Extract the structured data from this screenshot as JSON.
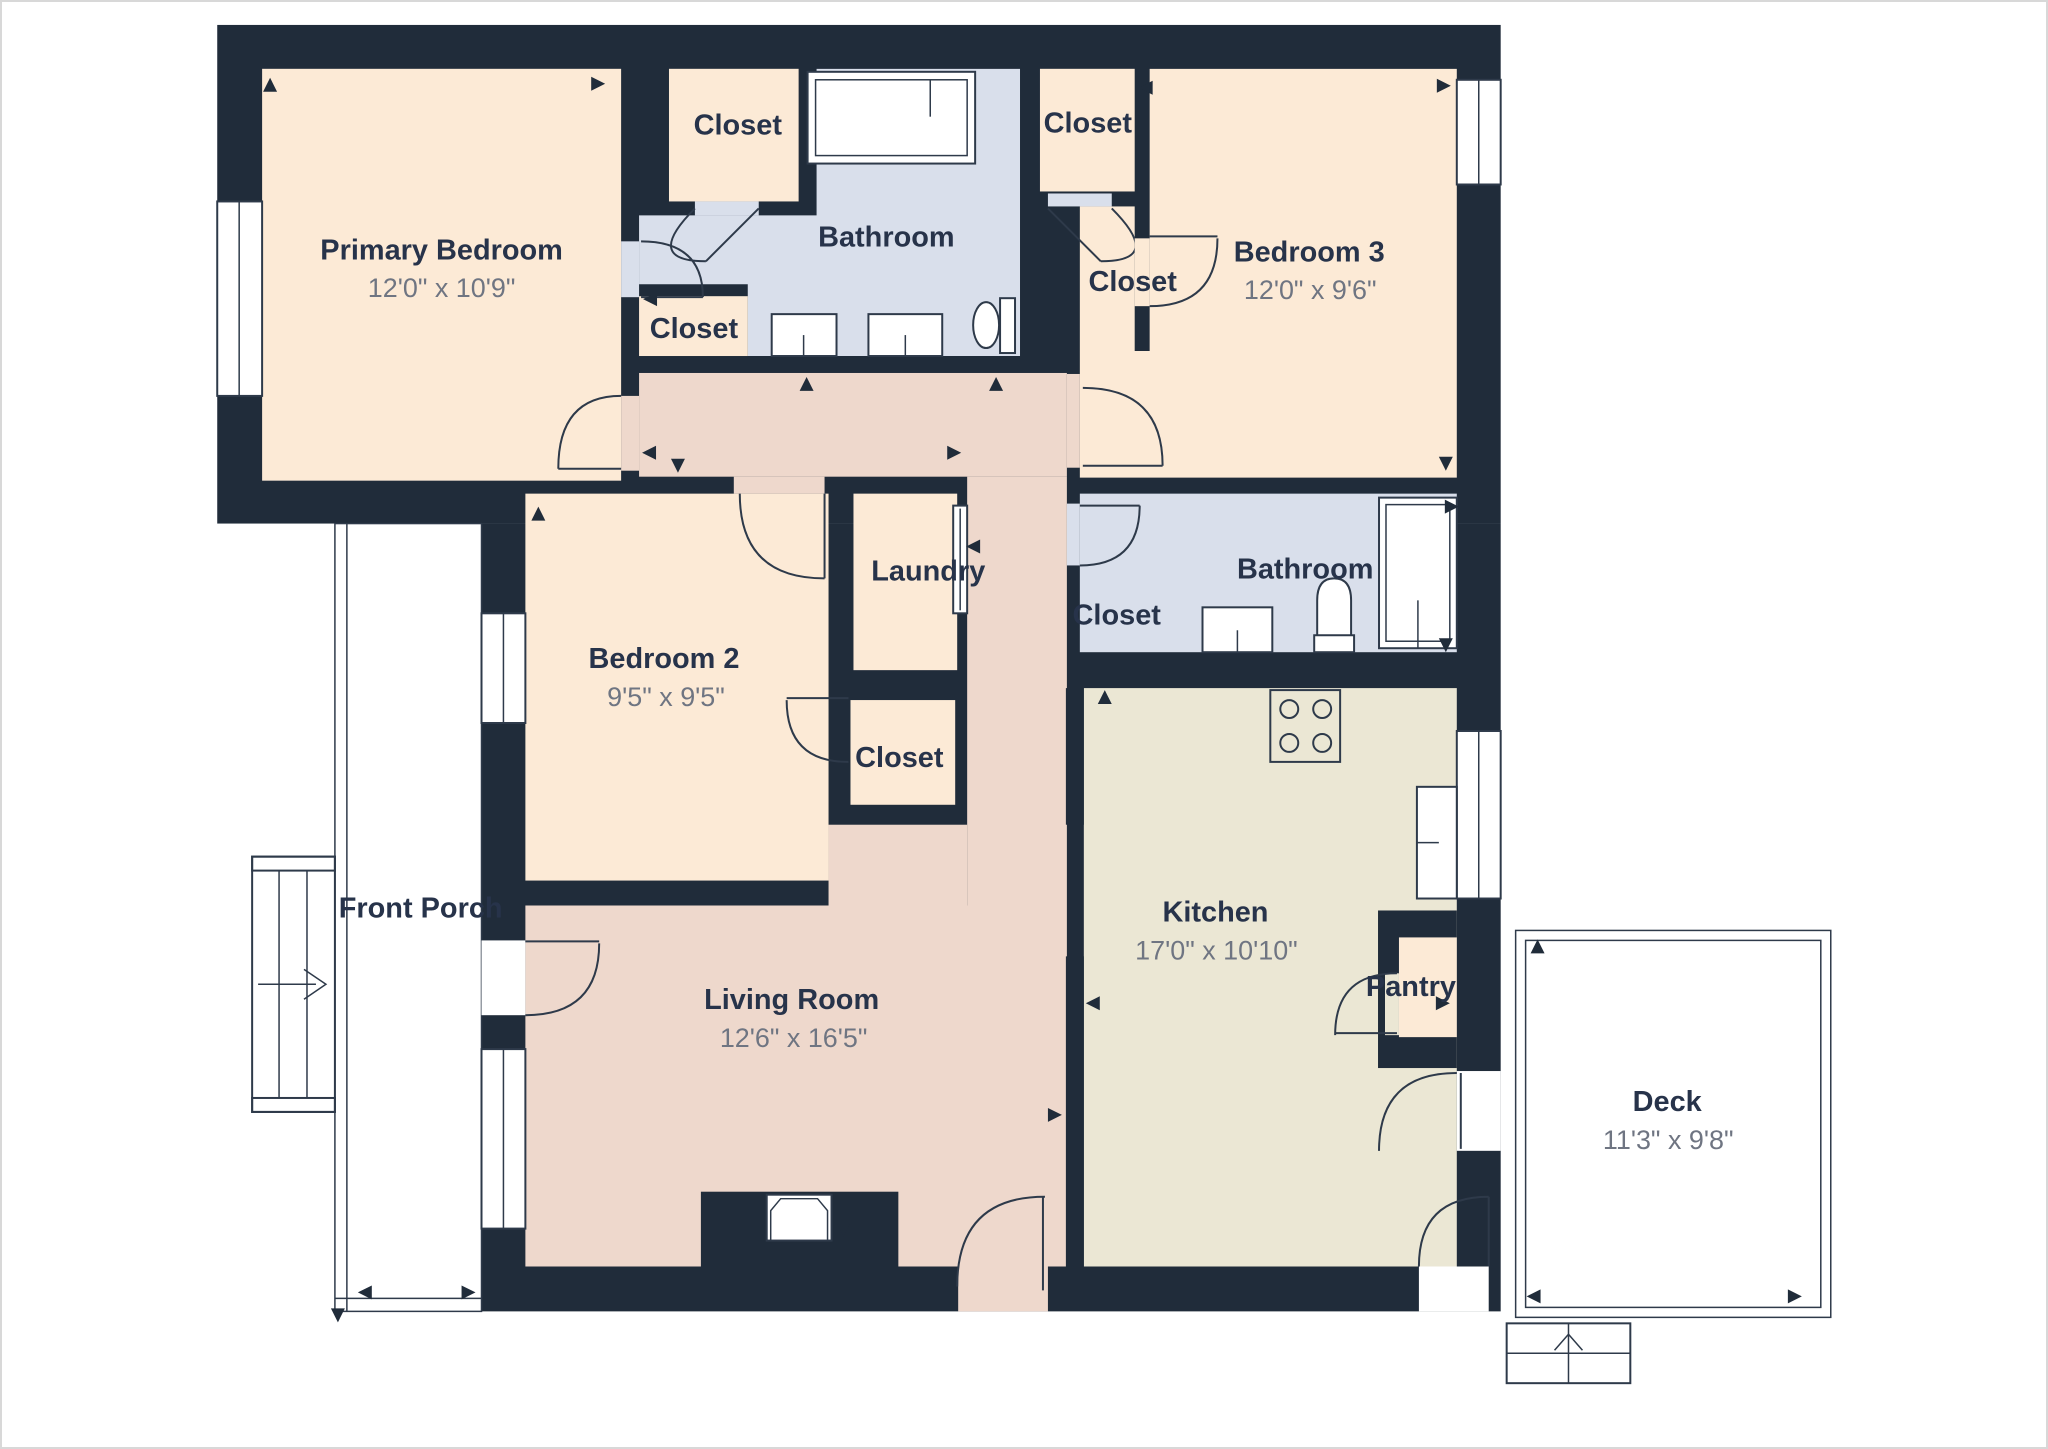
{
  "floor_plan": {
    "title": "Single-story house floor plan",
    "rooms": {
      "primary_bedroom": {
        "name": "Primary Bedroom",
        "dims": "12'0\" x 10'9\""
      },
      "bedroom_2": {
        "name": "Bedroom 2",
        "dims": "9'5\" x 9'5\""
      },
      "bedroom_3": {
        "name": "Bedroom 3",
        "dims": "12'0\" x 9'6\""
      },
      "living_room": {
        "name": "Living Room",
        "dims": "12'6\" x 16'5\""
      },
      "kitchen": {
        "name": "Kitchen",
        "dims": "17'0\" x 10'10\""
      },
      "deck": {
        "name": "Deck",
        "dims": "11'3\" x 9'8\""
      },
      "bathroom": {
        "name": "Bathroom"
      },
      "laundry": {
        "name": "Laundry"
      },
      "pantry": {
        "name": "Pantry"
      },
      "front_porch": {
        "name": "Front Porch"
      },
      "closet": {
        "name": "Closet"
      }
    },
    "counts": {
      "bedrooms": 3,
      "bathrooms": 2,
      "closets": 6
    },
    "palette": {
      "wall": "#202c3a",
      "peach": "#fcead6",
      "blue": "#d9dfeb",
      "rose": "#eed8cc",
      "khaki": "#ebe7d4",
      "gray": "#ededee",
      "line": "#2e3a4a",
      "label": "#27334a",
      "dims": "#6f7582",
      "page": "#ffffff",
      "pageborder": "#d8d8d8"
    }
  }
}
